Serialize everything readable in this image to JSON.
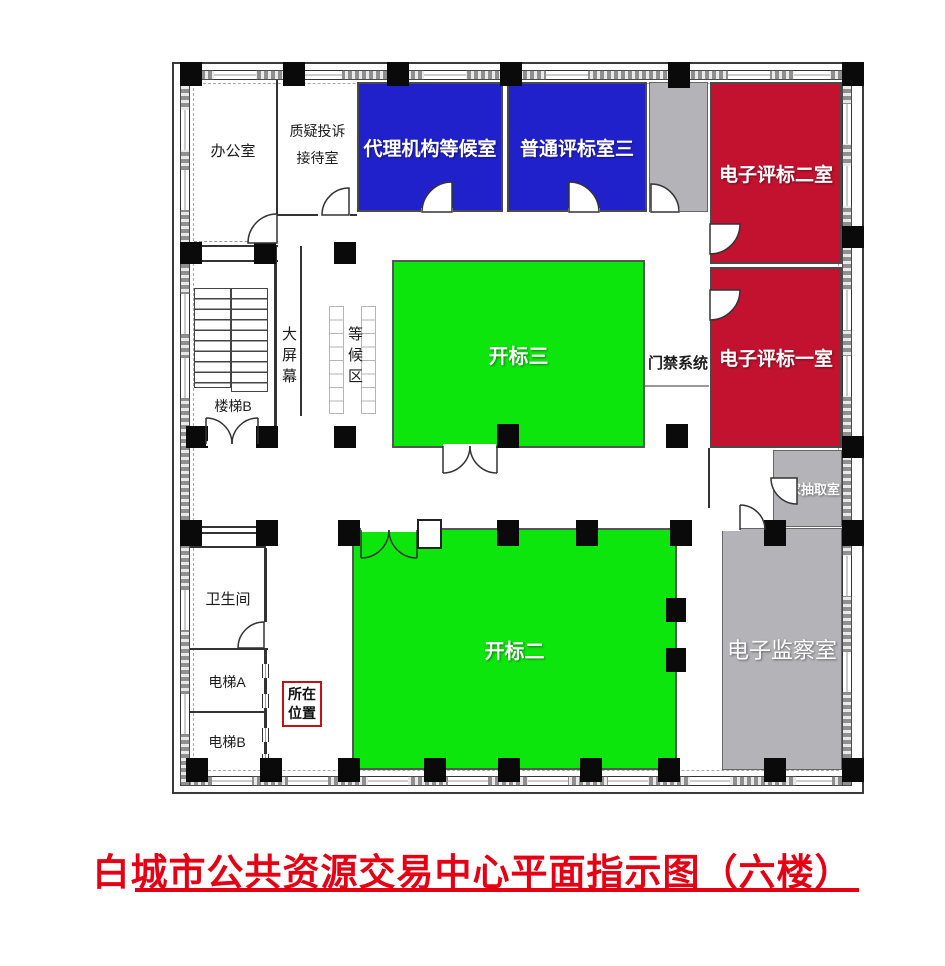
{
  "title": {
    "text": "白城市公共资源交易中心平面指示图（六楼）"
  },
  "colors": {
    "room_blue": "#2121CC",
    "room_red": "#C3122F",
    "room_green": "#0DE60D",
    "room_gray": "#B3B3B8",
    "title_red": "#E60014",
    "location_border_red": "#C41111"
  },
  "rooms": {
    "office": {
      "label": "办公室"
    },
    "complaint_reception": {
      "line1": "质疑投诉",
      "line2": "接待室"
    },
    "agency_waiting": {
      "label": "代理机构等候室"
    },
    "general_bid_eval_3": {
      "label": "普通评标室三"
    },
    "e_bid_eval_2": {
      "label": "电子评标二室"
    },
    "e_bid_eval_1": {
      "label": "电子评标一室"
    },
    "bid_opening_3": {
      "label": "开标三"
    },
    "bid_opening_2": {
      "label": "开标二"
    },
    "expert_drawing": {
      "label": "专家抽取室"
    },
    "e_monitoring": {
      "label": "电子监察室"
    },
    "toilet": {
      "label": "卫生间"
    },
    "elevator_a": {
      "label": "电梯A"
    },
    "elevator_b": {
      "label": "电梯B"
    },
    "stairs_b": {
      "label": "楼梯B"
    }
  },
  "annotations": {
    "big_screen": {
      "label": "大屏幕"
    },
    "waiting_zone": {
      "label": "等候区"
    },
    "access_control": {
      "label": "门禁系统"
    },
    "current_location": {
      "line1": "所在",
      "line2": "位置"
    }
  }
}
